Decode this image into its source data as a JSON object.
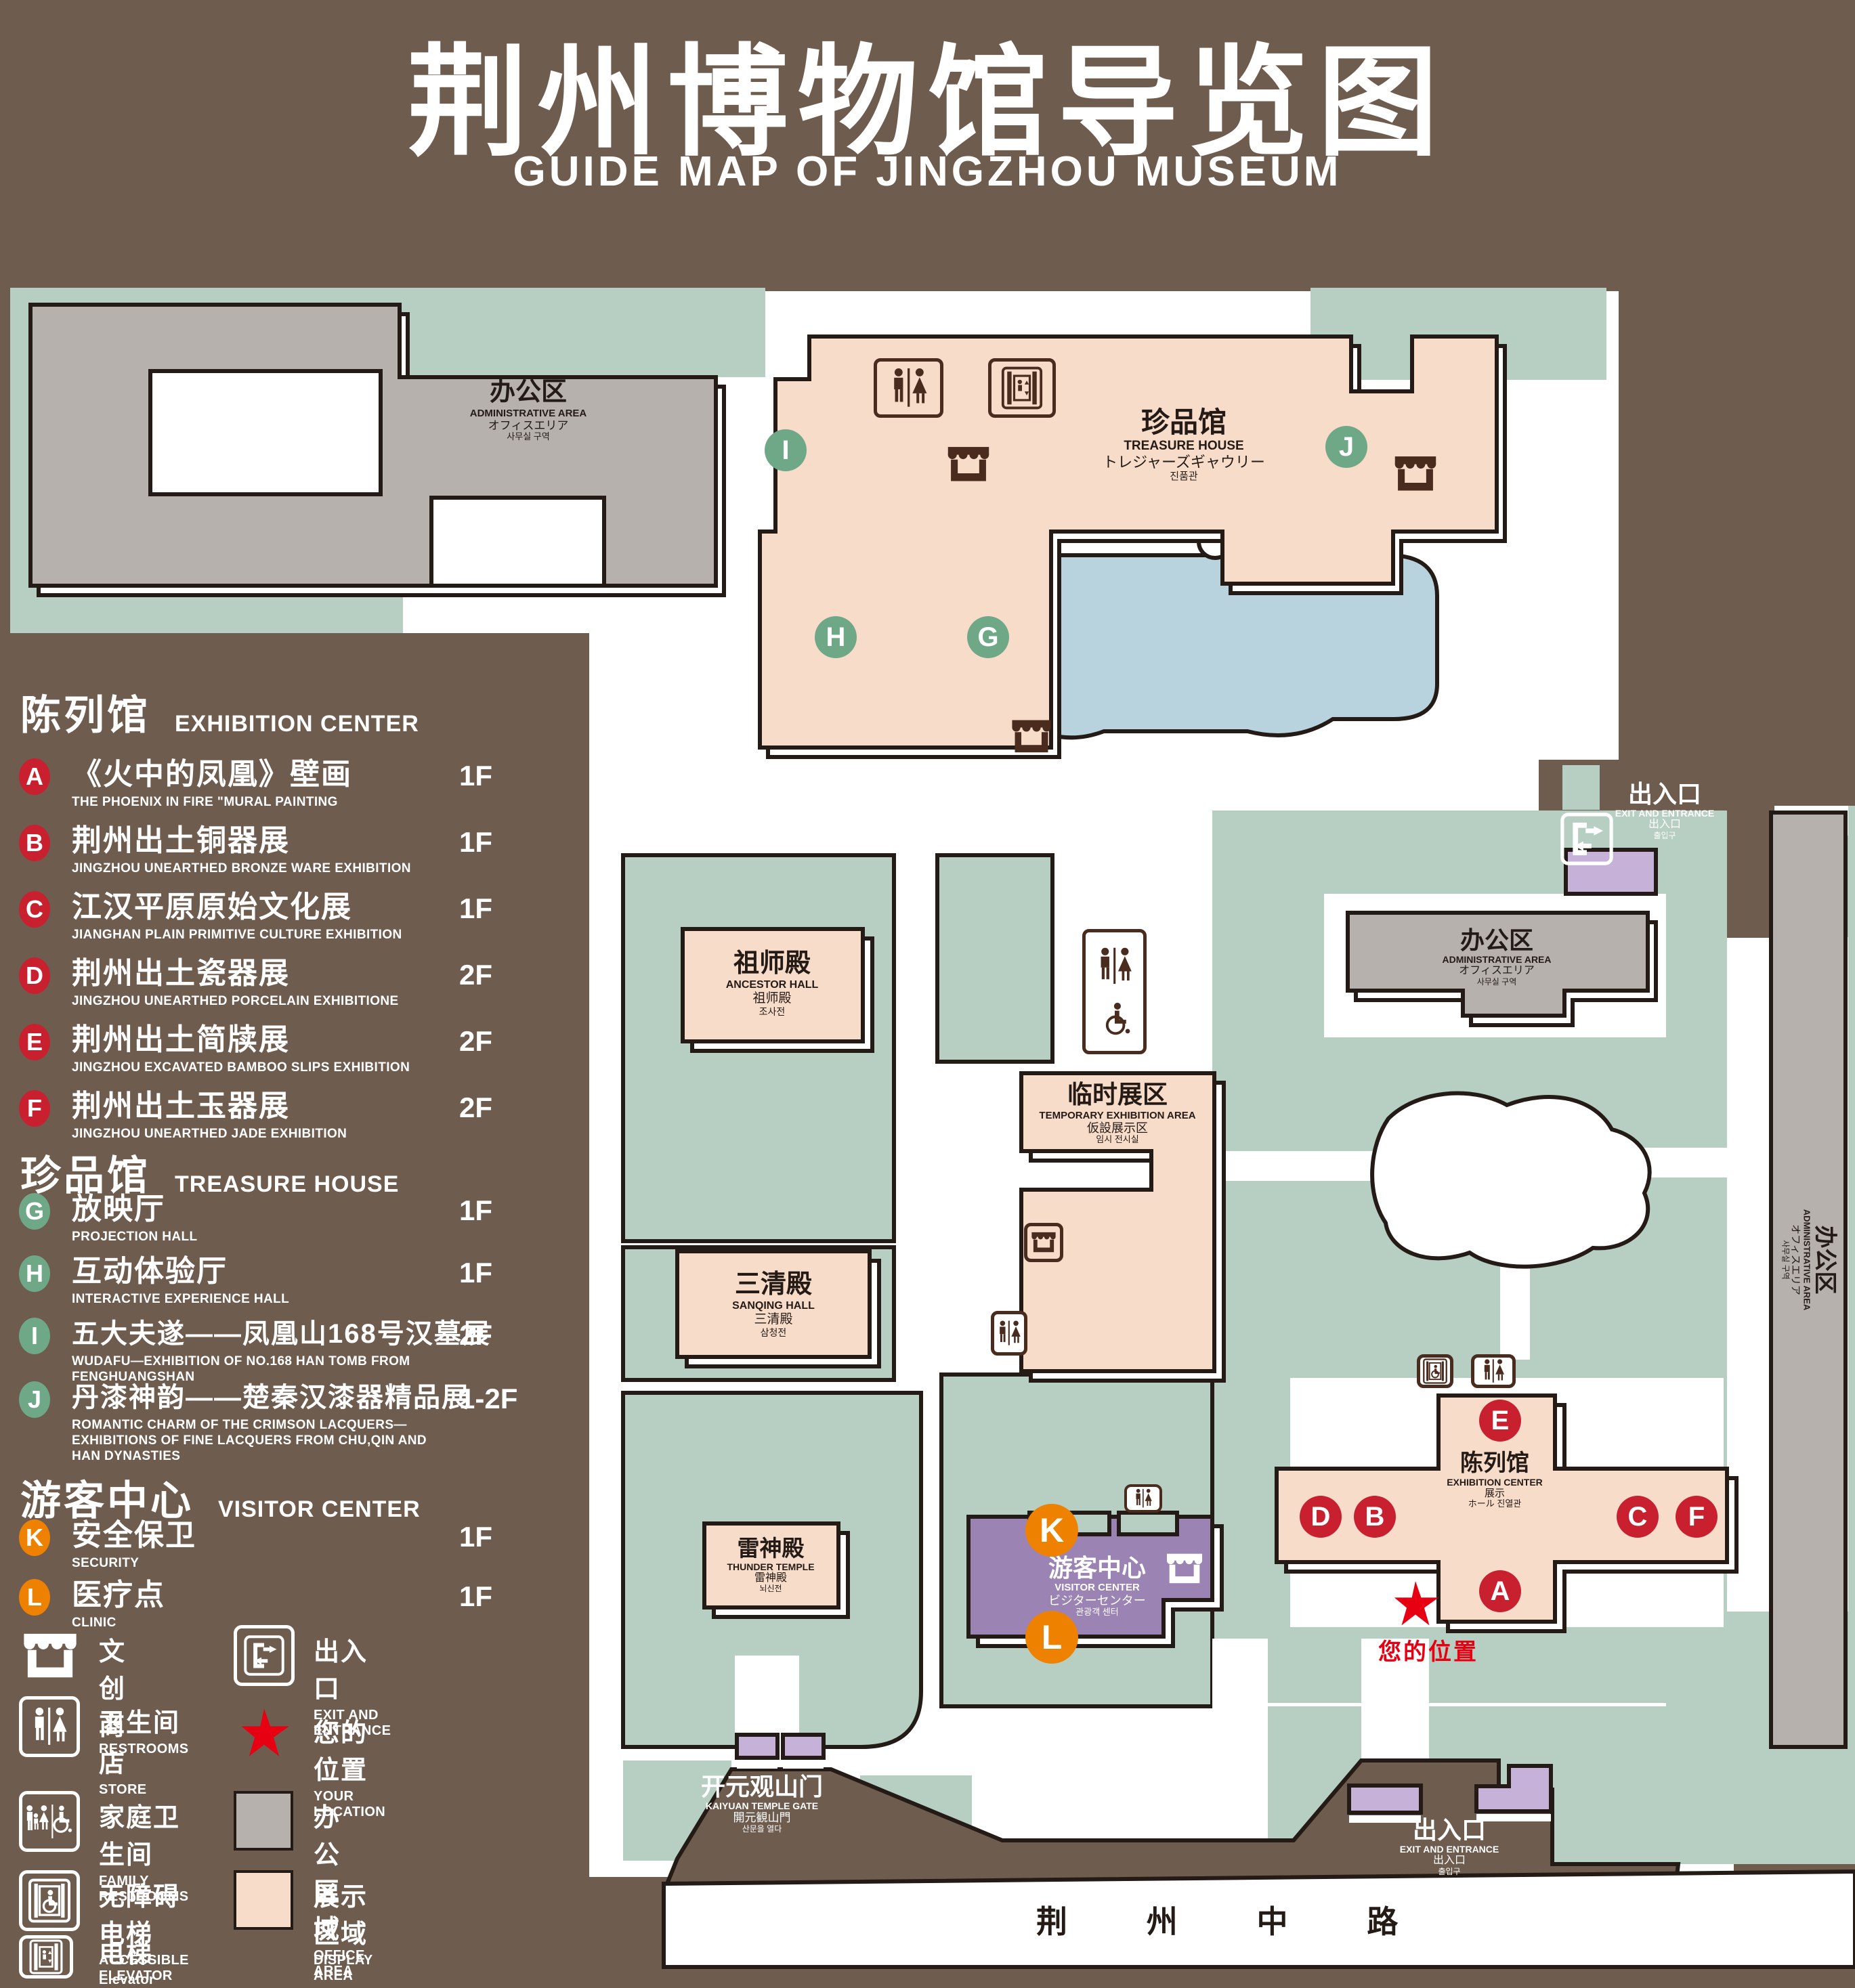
{
  "title": {
    "zh": "荆州博物馆导览图",
    "en": "GUIDE MAP OF JINGZHOU MUSEUM"
  },
  "legend": {
    "sections": [
      {
        "zh": "陈列馆",
        "en": "EXHIBITION CENTER",
        "items": [
          {
            "letter": "A",
            "zh": "《火中的凤凰》壁画",
            "en": "THE PHOENIX IN FIRE \"MURAL PAINTING",
            "floor": "1F"
          },
          {
            "letter": "B",
            "zh": "荆州出土铜器展",
            "en": "JINGZHOU UNEARTHED BRONZE WARE EXHIBITION",
            "floor": "1F"
          },
          {
            "letter": "C",
            "zh": "江汉平原原始文化展",
            "en": "JIANGHAN PLAIN PRIMITIVE CULTURE EXHIBITION",
            "floor": "1F"
          },
          {
            "letter": "D",
            "zh": "荆州出土瓷器展",
            "en": "JINGZHOU UNEARTHED PORCELAIN EXHIBITIONE",
            "floor": "2F"
          },
          {
            "letter": "E",
            "zh": "荆州出土简牍展",
            "en": "JINGZHOU EXCAVATED BAMBOO SLIPS EXHIBITION",
            "floor": "2F"
          },
          {
            "letter": "F",
            "zh": "荆州出土玉器展",
            "en": "JINGZHOU UNEARTHED JADE EXHIBITION",
            "floor": "2F"
          }
        ]
      },
      {
        "zh": "珍品馆",
        "en": "TREASURE HOUSE",
        "items": [
          {
            "letter": "G",
            "zh": "放映厅",
            "en": "PROJECTION HALL",
            "floor": "1F"
          },
          {
            "letter": "H",
            "zh": "互动体验厅",
            "en": "INTERACTIVE EXPERIENCE HALL",
            "floor": "1F"
          },
          {
            "letter": "I",
            "zh": "五大夫遂——凤凰山168号汉墓展",
            "en": "WUDAFU—EXHIBITION OF NO.168 HAN TOMB FROM FENGHUANGSHAN",
            "floor": "2F"
          },
          {
            "letter": "J",
            "zh": "丹漆神韵——楚秦汉漆器精品展",
            "en": "ROMANTIC CHARM OF THE CRIMSON LACQUERS—EXHIBITIONS OF FINE LACQUERS FROM CHU,QIN AND HAN DYNASTIES",
            "floor": "1-2F"
          }
        ]
      },
      {
        "zh": "游客中心",
        "en": "VISITOR CENTER",
        "items": [
          {
            "letter": "K",
            "zh": "安全保卫",
            "en": "SECURITY",
            "floor": "1F"
          },
          {
            "letter": "L",
            "zh": "医疗点",
            "en": "CLINIC",
            "floor": "1F"
          }
        ]
      }
    ],
    "symbols": [
      {
        "icon": "store-icon",
        "zh": "文创商店",
        "en": "STORE"
      },
      {
        "icon": "restroom-icon",
        "zh": "卫生间",
        "en": "RESTROOMS"
      },
      {
        "icon": "family-restroom-icon",
        "zh": "家庭卫生间",
        "en": "FAMILY RESTROOMS"
      },
      {
        "icon": "accessible-elevator-icon",
        "zh": "无障碍电梯",
        "en": "ACCESSIBLE ELEVATOR"
      },
      {
        "icon": "elevator-icon",
        "zh": "电梯",
        "en": "Elevator"
      },
      {
        "icon": "exit-icon",
        "zh": "出入口",
        "en": "EXIT AND ENTRANCE"
      },
      {
        "icon": "location-star-icon",
        "zh": "您的位置",
        "en": "YOUR LOCATION"
      },
      {
        "icon": "office-swatch",
        "zh": "办公区域",
        "en": "OFFICE AREA"
      },
      {
        "icon": "display-swatch",
        "zh": "展示区域",
        "en": "DISPLAY AREA"
      }
    ]
  },
  "map": {
    "badges": [
      "A",
      "B",
      "C",
      "D",
      "E",
      "F",
      "G",
      "H",
      "I",
      "J",
      "K",
      "L"
    ],
    "admin_area": {
      "zh": "办公区",
      "en": "ADMINISTRATIVE AREA",
      "jp": "オフィスエリア",
      "kr": "사무실 구역"
    },
    "treasure_house": {
      "zh": "珍品馆",
      "en": "TREASURE HOUSE",
      "jp": "トレジャーズギャウリー",
      "kr": "진품관"
    },
    "ancestor_hall": {
      "zh": "祖师殿",
      "en": "ANCESTOR HALL",
      "jp": "祖师殿",
      "kr": "조사전"
    },
    "temporary_area": {
      "zh": "临时展区",
      "en": "TEMPORARY EXHIBITION AREA",
      "jp": "仮設展示区",
      "kr": "임시 전시실"
    },
    "sanqing_hall": {
      "zh": "三清殿",
      "en": "SANQING HALL",
      "jp": "三清殿",
      "kr": "삼청전"
    },
    "thunder_temple": {
      "zh": "雷神殿",
      "en": "THUNDER TEMPLE",
      "jp": "雷神殿",
      "kr": "뇌신전"
    },
    "visitor_center": {
      "zh": "游客中心",
      "en": "VISITOR CENTER",
      "jp": "ビジターセンター",
      "kr": "관광객 센터"
    },
    "exhibition_center": {
      "zh": "陈列馆",
      "en": "EXHIBITION CENTER",
      "jp": "展示",
      "kr": "ホール 진열관"
    },
    "exit": {
      "zh": "出入口",
      "en": "EXIT AND ENTRANCE",
      "jp": "出入口",
      "kr": "출입구"
    },
    "gate": {
      "zh": "开元观山门",
      "en": "KAIYUAN TEMPLE GATE",
      "jp": "開元観山門",
      "kr": "산문을 열다"
    },
    "road": "荆 州 中 路",
    "your_location": "您的位置"
  },
  "colors": {
    "background": "#6e5c4f",
    "display_area": "#f8dcca",
    "office_area": "#b6b1ad",
    "green_area": "#b7cfc2",
    "visitor_center": "#9b83b4",
    "gate_purple": "#c6b1d8",
    "lake": "#b9d3de",
    "badge_red": "#c8202f",
    "badge_green": "#6fa887",
    "badge_orange": "#ee8200",
    "location_red": "#e60012",
    "outline": "#241b16"
  }
}
